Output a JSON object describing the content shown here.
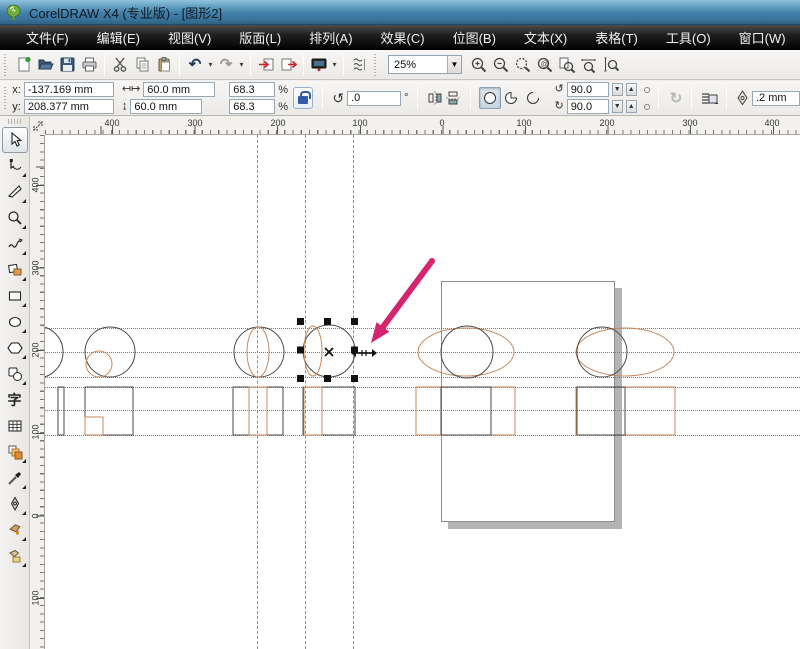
{
  "window": {
    "title": "CorelDRAW X4 (专业版) - [图形2]"
  },
  "menu": {
    "items": [
      "文件(F)",
      "编辑(E)",
      "视图(V)",
      "版面(L)",
      "排列(A)",
      "效果(C)",
      "位图(B)",
      "文本(X)",
      "表格(T)",
      "工具(O)",
      "窗口(W)",
      "帮助(H)"
    ]
  },
  "toolbar": {
    "zoom_level": "25%",
    "icons": [
      "new",
      "open",
      "save",
      "print",
      "cut",
      "copy",
      "paste",
      "undo",
      "redo",
      "import",
      "export",
      "app-launcher",
      "view-options",
      "zoom-in",
      "zoom-out",
      "zoom-selected",
      "zoom-all",
      "zoom-page",
      "zoom-width",
      "zoom-height"
    ]
  },
  "property_bar": {
    "x_label": "x:",
    "x_value": "-137.169 mm",
    "y_label": "y:",
    "y_value": "208.377 mm",
    "width_value": "60.0 mm",
    "height_value": "60.0 mm",
    "scale_x": "68.3",
    "scale_y": "68.3",
    "percent": "%",
    "rotation_value": ".0",
    "degree": "°",
    "angle_start": "90.0",
    "angle_end": "90.0",
    "outline_width": ".2 mm",
    "shape_modes": [
      "ellipse",
      "pie",
      "arc"
    ],
    "active_shape_mode": "ellipse"
  },
  "toolbox": {
    "tools": [
      "pick-tool",
      "shape-tool",
      "crop-tool",
      "zoom-tool",
      "freehand-tool",
      "smart-fill-tool",
      "rectangle-tool",
      "ellipse-tool",
      "polygon-tool",
      "basic-shapes-tool",
      "text-tool",
      "table-tool",
      "blend-tool",
      "eyedropper-tool",
      "outline-pen-tool",
      "fill-tool",
      "interactive-fill-tool"
    ],
    "text_tool_glyph": "字",
    "selected_tool": "pick-tool"
  },
  "rulers": {
    "horizontal": [
      {
        "label": "400",
        "x": 67
      },
      {
        "label": "300",
        "x": 150
      },
      {
        "label": "200",
        "x": 233
      },
      {
        "label": "100",
        "x": 315
      },
      {
        "label": "0",
        "x": 397
      },
      {
        "label": "100",
        "x": 479
      },
      {
        "label": "200",
        "x": 562
      },
      {
        "label": "300",
        "x": 645
      },
      {
        "label": "400",
        "x": 727
      }
    ],
    "vertical": [
      {
        "label": "400",
        "y": 50
      },
      {
        "label": "300",
        "y": 133
      },
      {
        "label": "200",
        "y": 215
      },
      {
        "label": "100",
        "y": 297
      },
      {
        "label": "0",
        "y": 381
      },
      {
        "label": "100",
        "y": 463
      }
    ]
  },
  "canvas": {
    "size": {
      "w": 755,
      "h": 514
    },
    "colors": {
      "black": "#4a4a4a",
      "orange": "#c9895a",
      "arrow": "#d6246e",
      "handle": "#111111",
      "page_border": "#8e8e8e",
      "page_shadow": "#b4b4b4"
    },
    "guidelines": {
      "horizontal": [
        193,
        217,
        242,
        252,
        275,
        300
      ],
      "vertical": [
        212,
        260,
        308
      ]
    },
    "shapes": [
      {
        "type": "circle",
        "name": "partial-circle",
        "cx": -8,
        "cy": 217,
        "r": 26,
        "stroke": "black"
      },
      {
        "type": "circle",
        "name": "circle-1",
        "cx": 65,
        "cy": 217,
        "r": 25,
        "stroke": "black"
      },
      {
        "type": "circle",
        "name": "circle-1-inner",
        "cx": 54,
        "cy": 229,
        "r": 13,
        "stroke": "orange"
      },
      {
        "type": "circle",
        "name": "circle-2",
        "cx": 214,
        "cy": 217,
        "r": 25,
        "stroke": "black"
      },
      {
        "type": "ellipse",
        "name": "circle-2-lens",
        "cx": 213,
        "cy": 217,
        "rx": 11,
        "ry": 25,
        "stroke": "orange"
      },
      {
        "type": "circle",
        "name": "circle-3-selected",
        "cx": 284,
        "cy": 216,
        "r": 26,
        "stroke": "black"
      },
      {
        "type": "ellipse",
        "name": "circle-3-lens",
        "cx": 268,
        "cy": 216,
        "rx": 9,
        "ry": 25,
        "stroke": "orange"
      },
      {
        "type": "ellipse",
        "name": "ellipse-right-1",
        "cx": 421,
        "cy": 217,
        "rx": 48,
        "ry": 24,
        "stroke": "orange"
      },
      {
        "type": "circle",
        "name": "circle-right-1",
        "cx": 422,
        "cy": 217,
        "r": 26,
        "stroke": "black"
      },
      {
        "type": "ellipse",
        "name": "ellipse-right-2",
        "cx": 580,
        "cy": 217,
        "rx": 49,
        "ry": 24,
        "stroke": "orange"
      },
      {
        "type": "circle",
        "name": "circle-right-2",
        "cx": 557,
        "cy": 217,
        "r": 25,
        "stroke": "black"
      },
      {
        "type": "rect",
        "name": "thin-bar",
        "x": 13,
        "y": 252,
        "w": 6,
        "h": 48,
        "stroke": "black"
      },
      {
        "type": "rect",
        "name": "rect-1",
        "x": 40,
        "y": 252,
        "w": 48,
        "h": 48,
        "stroke": "black"
      },
      {
        "type": "rect",
        "name": "rect-1-inner",
        "x": 40,
        "y": 282,
        "w": 18,
        "h": 18,
        "stroke": "orange"
      },
      {
        "type": "rect",
        "name": "rect-2",
        "x": 188,
        "y": 252,
        "w": 50,
        "h": 48,
        "stroke": "black"
      },
      {
        "type": "rect",
        "name": "rect-2-inner",
        "x": 204,
        "y": 252,
        "w": 18,
        "h": 48,
        "stroke": "orange"
      },
      {
        "type": "rect",
        "name": "rect-3",
        "x": 258,
        "y": 252,
        "w": 52,
        "h": 48,
        "stroke": "black"
      },
      {
        "type": "rect",
        "name": "rect-3-inner",
        "x": 259,
        "y": 252,
        "w": 18,
        "h": 48,
        "stroke": "orange"
      },
      {
        "type": "rect",
        "name": "rect-right-1-orange",
        "x": 371,
        "y": 252,
        "w": 99,
        "h": 48,
        "stroke": "orange"
      },
      {
        "type": "rect",
        "name": "rect-right-1",
        "x": 396,
        "y": 252,
        "w": 50,
        "h": 48,
        "stroke": "black"
      },
      {
        "type": "rect",
        "name": "rect-right-2-orange",
        "x": 531,
        "y": 252,
        "w": 99,
        "h": 48,
        "stroke": "orange"
      },
      {
        "type": "rect",
        "name": "rect-right-2",
        "x": 532,
        "y": 252,
        "w": 48,
        "h": 48,
        "stroke": "black"
      },
      {
        "type": "handles",
        "name": "selection-handles",
        "x": 252,
        "y": 183,
        "w": 61,
        "h": 64
      },
      {
        "type": "xmark",
        "name": "selection-center",
        "x": 284,
        "y": 217
      },
      {
        "type": "hmove",
        "name": "resize-cursor",
        "x": 319,
        "y": 218
      },
      {
        "type": "arrow",
        "name": "annotation-arrow",
        "x1": 387,
        "y1": 126,
        "x2": 326,
        "y2": 208
      }
    ]
  }
}
